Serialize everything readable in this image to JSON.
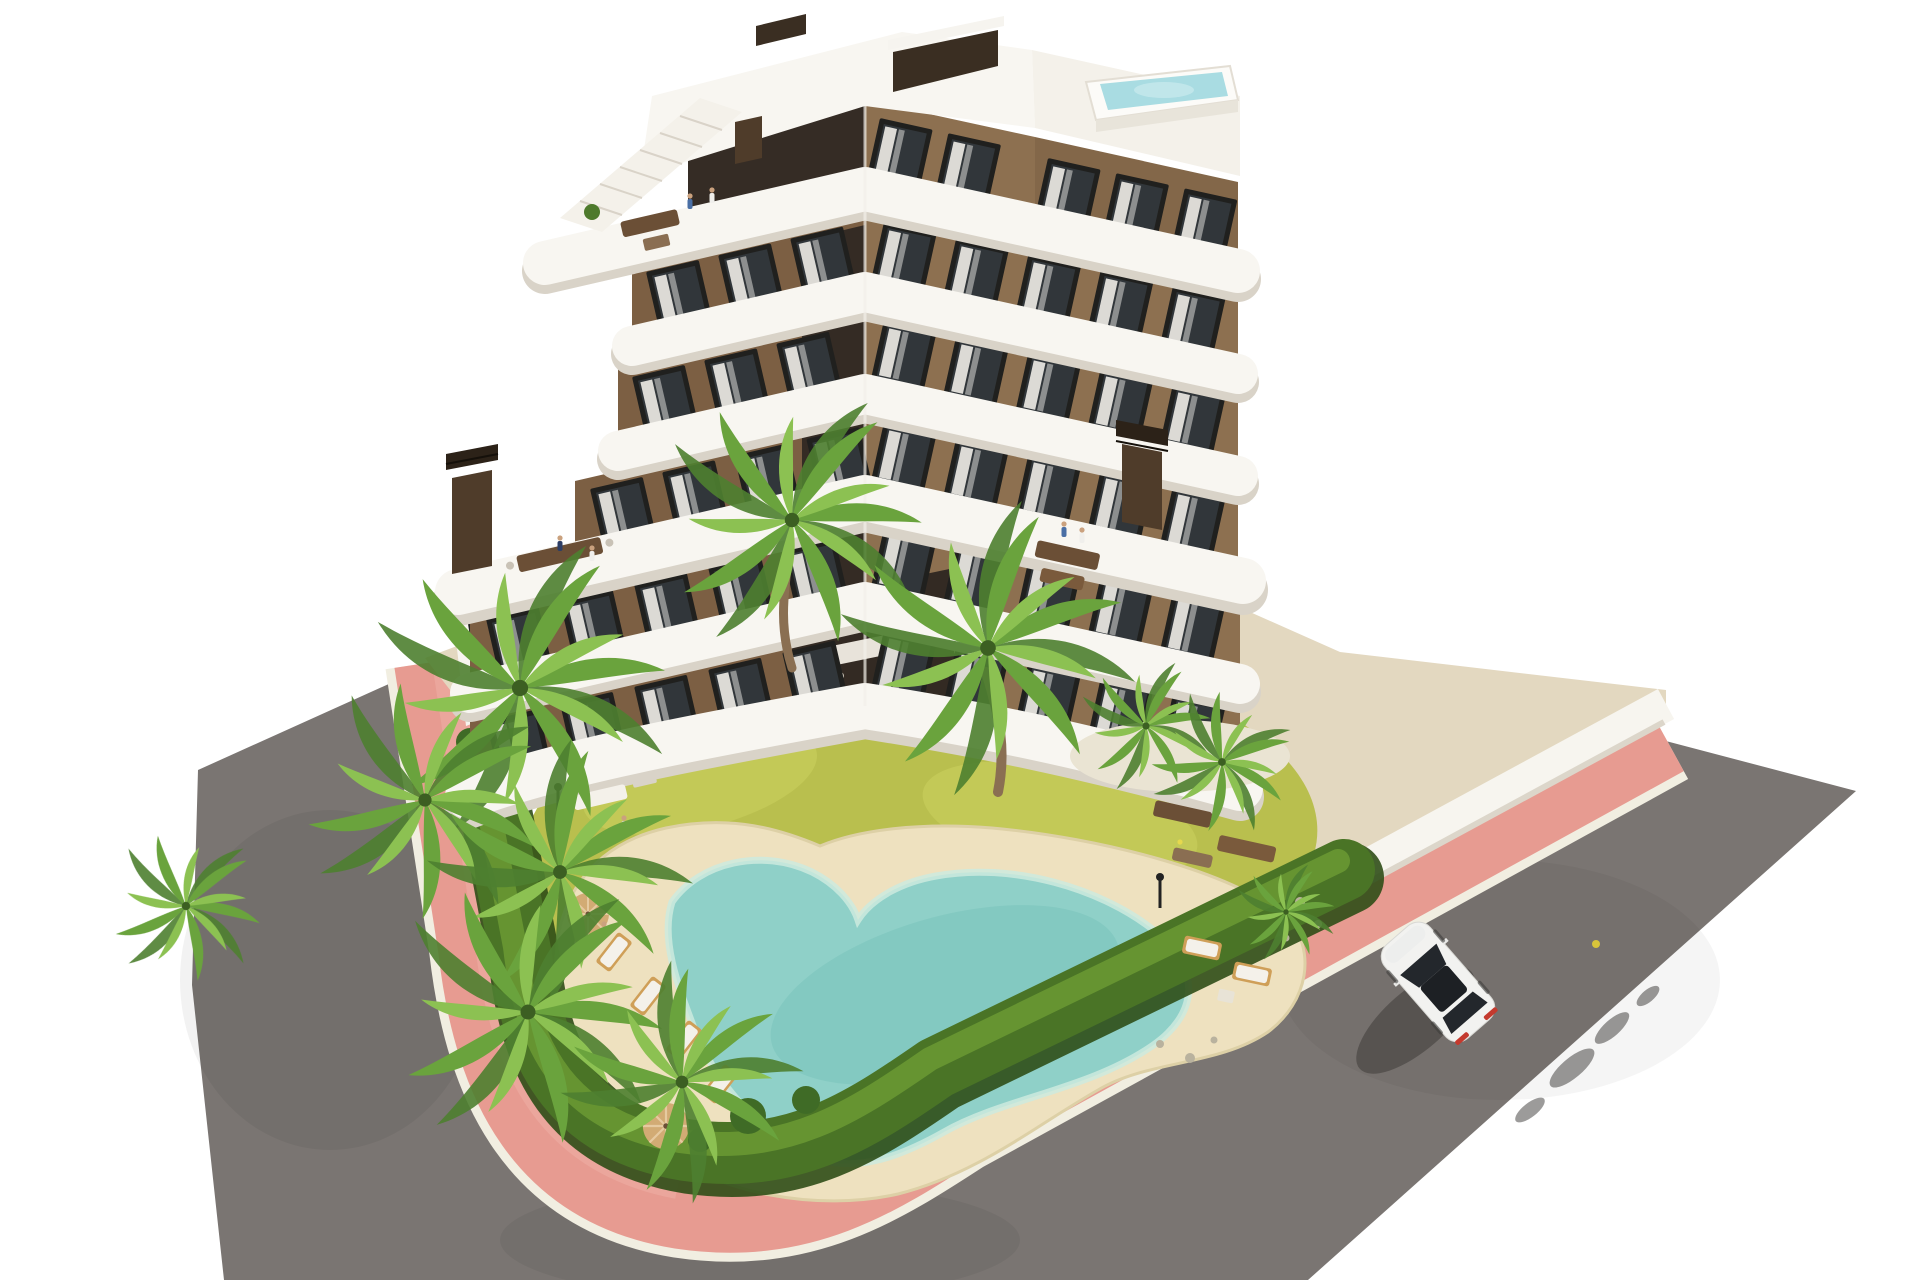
{
  "scene": {
    "type": "aerial-architectural-render",
    "subject": "modern apartment building with garden, free-form pool, pink sidewalk and asphalt road",
    "background": "white"
  },
  "colors": {
    "bg": "#ffffff",
    "road": "#7a7572",
    "road_dark": "#5c5956",
    "pink": "#e79b91",
    "pink_light": "#f0b2a7",
    "curb": "#f1eee1",
    "beige": "#e3d8c0",
    "wall_white": "#f7f5ef",
    "wall_shadow": "#dcd6ca",
    "lawn": "#b9bf4e",
    "lawn_light": "#ccd160",
    "flower_yellow": "#e6d84e",
    "hedge": "#4a7426",
    "hedge_dark": "#2f4e17",
    "hedge_light": "#6d9c35",
    "sand": "#eee1bf",
    "sand_edge": "#ddd0a6",
    "pool": "#8fd0c8",
    "pool_deep": "#7cc5bd",
    "pool_rim": "#cdeade",
    "rooftop_pool": "#a9dce2",
    "island": "#eae4d3",
    "band_white": "#f8f6f1",
    "band_shadow": "#d9d3c8",
    "facade_left": "#7c5f43",
    "facade_right": "#8d7050",
    "facade_dark": "#352c25",
    "core_dark": "#2e2722",
    "window_frame": "#20201e",
    "window_glass": "#31363a",
    "curtain": "#eae8e3",
    "chimney": "#4f3c2a",
    "chimney_cap": "#2c2218",
    "palm_dark": "#4e8030",
    "palm_mid": "#6aa33d",
    "palm_light": "#8cc152",
    "trunk": "#8a6f52",
    "wood": "#6b4f36",
    "lounger_wood": "#cf9f58",
    "cushion": "#f4f1ea",
    "parasol": "#d2ab74",
    "car_body": "#f2f2f0",
    "car_glass": "#23272c",
    "taillight": "#c43a2e",
    "lamp": "#222222",
    "pebble": "#d9d2bf"
  },
  "counts": {
    "visible_floors": 7,
    "cars": 1,
    "parasols": 2,
    "sun_loungers": 6,
    "chimneys": 2,
    "rooftop_pools": 1
  }
}
